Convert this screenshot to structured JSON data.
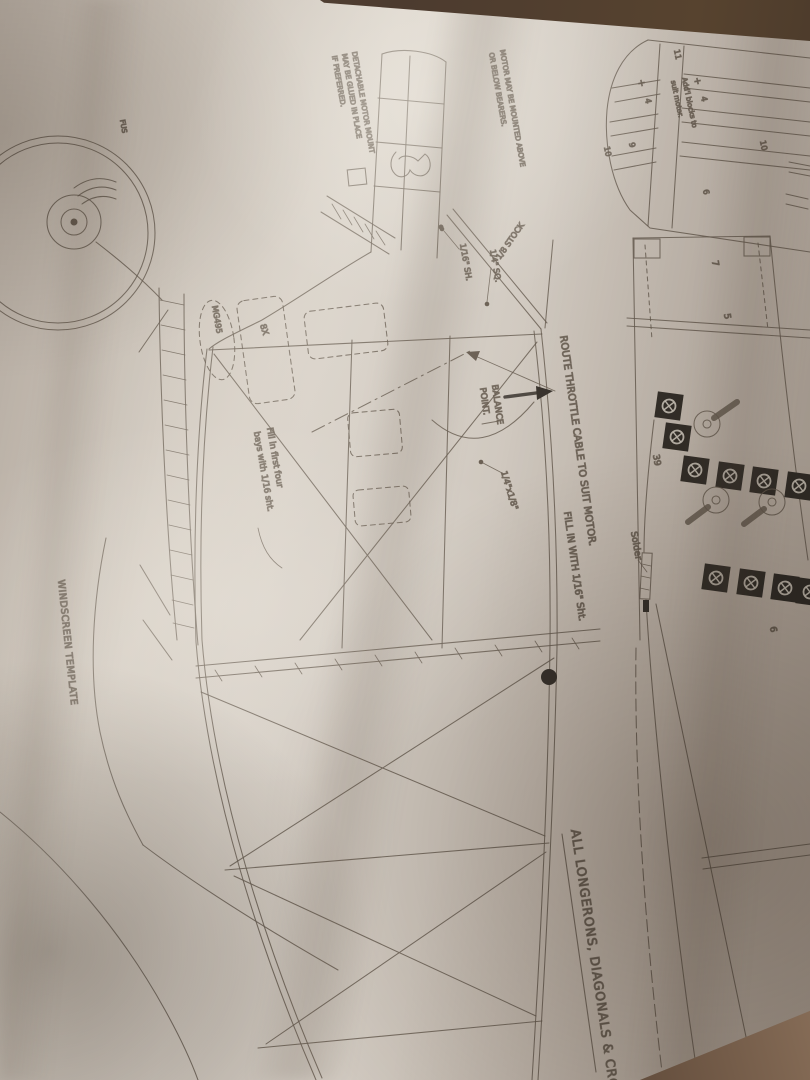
{
  "colors": {
    "paper": "#cdc5bb",
    "table_dark": "#463629",
    "table_light": "#8a705a",
    "ink": "#6a5f53",
    "ink_dark": "#35302a",
    "text": "#564c40"
  },
  "labels": {
    "windscreen_template": "WINDSCREEN TEMPLATE",
    "route_throttle": "ROUTE THROTTLE CABLE TO SUIT MOTOR.",
    "fill_in": "FILL IN WITH 1/16\" Sht.",
    "all_longerons": "ALL LONGERONS, DIAGONALS & CROSS",
    "balance_1": "BALANCE",
    "balance_2": "POINT.",
    "detachable_1": "DETACHABLE MOTOR MOUNT",
    "detachable_2": "MAY BE GLUED IN PLACE",
    "detachable_3": "IF PREFERRED.",
    "motor_mount_1": "MOTOR MAY BE MOUNTED ABOVE",
    "motor_mount_2": "OR BELOW BEARERS.",
    "stock": "1/8 STOCK",
    "quarter_sq": "1/4\" SQ.",
    "sixteenth_sht": "1/16\" SH.",
    "quarter_by_eighth": "1/4\"x1/8\"",
    "solder": "Solder",
    "addl_blocks_1": "Add'l blocks to",
    "addl_blocks_2": "suit motor.",
    "fill_bays_1": "Fill in first four",
    "fill_bays_2": "bays with 1/16 sht.",
    "mg495": "MG495",
    "eight_x": "8X",
    "fus": "FUS"
  },
  "numbers": {
    "five": "5",
    "seven": "7",
    "thirty_nine": "39",
    "six_a": "6",
    "six_b": "6",
    "nine": "9",
    "ten_a": "10",
    "ten_b": "10",
    "eleven": "11",
    "four_a": "4",
    "four_b": "4",
    "plus_a": "+",
    "plus_b": "+"
  }
}
